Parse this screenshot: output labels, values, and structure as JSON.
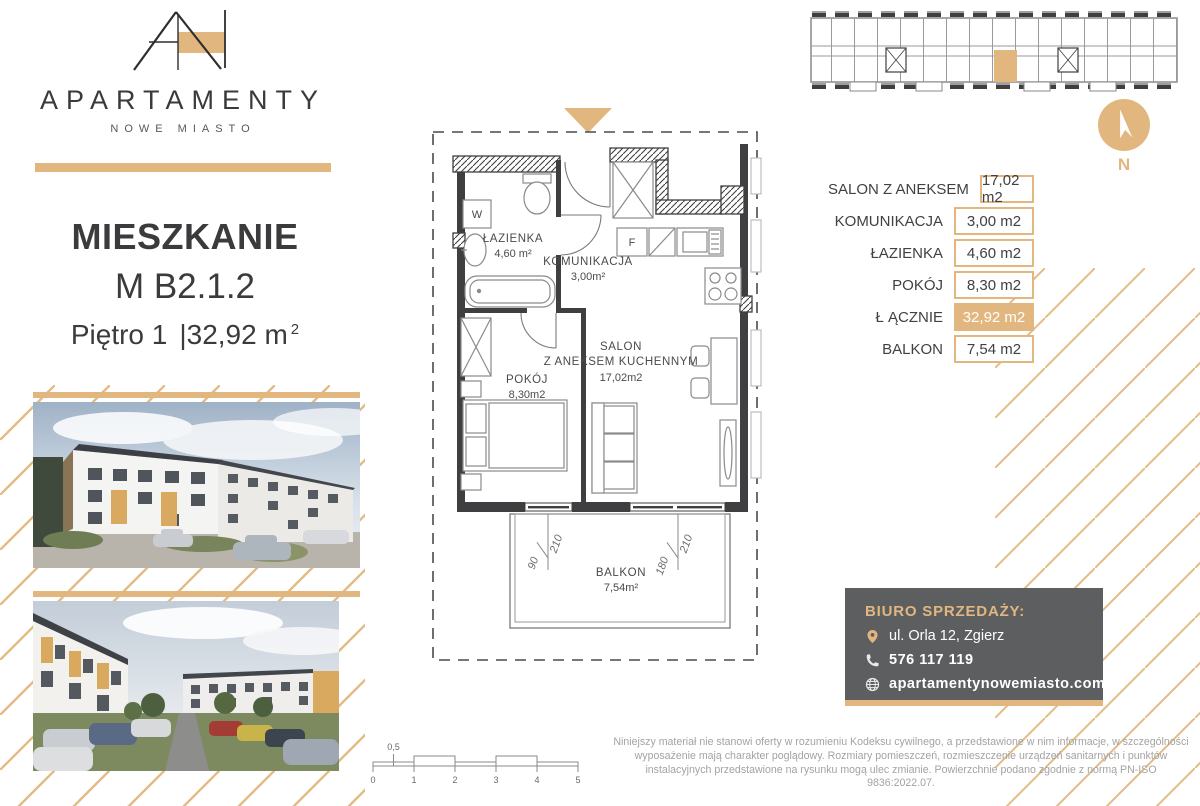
{
  "colors": {
    "gold": "#e2b77f",
    "dark_box": "#5d5e60",
    "line_dark": "#3f3f41",
    "text_gray": "#a3a3a3"
  },
  "brand": {
    "monogram": "AN",
    "name": "APARTAMENTY",
    "subtitle": "NOWE MIASTO"
  },
  "listing": {
    "title": "MIESZKANIE",
    "unit": "M B2.1.2",
    "floor": "Piętro 1",
    "area": "|32,92 m",
    "area_sup": "2"
  },
  "plan": {
    "rooms": {
      "lazienka": {
        "name": "ŁAZIENKA",
        "area": "4,60 m²"
      },
      "komunikacja": {
        "name": "KOMUNIKACJA",
        "area": "3,00m²"
      },
      "salon": {
        "name1": "SALON",
        "name2": "Z ANEKSEM KUCHENNYM",
        "area": "17,02m2"
      },
      "pokoj": {
        "name": "POKÓJ",
        "area": "8,30m2"
      },
      "balkon": {
        "name": "BALKON",
        "area": "7,54m²"
      }
    },
    "letters": {
      "washer": "W",
      "fridge": "F"
    },
    "dims": {
      "w1a": "90",
      "w1b": "210",
      "w2a": "180",
      "w2b": "210"
    }
  },
  "areas_table": {
    "rows": [
      {
        "label": "SALON Z ANEKSEM",
        "value": "17,02 m2"
      },
      {
        "label": "KOMUNIKACJA",
        "value": "3,00 m2"
      },
      {
        "label": "ŁAZIENKA",
        "value": "4,60 m2"
      },
      {
        "label": "POKÓJ",
        "value": "8,30 m2"
      },
      {
        "label": "Ł ĄCZNIE",
        "value": "32,92 m2"
      },
      {
        "label": "BALKON",
        "value": "7,54 m2"
      }
    ]
  },
  "compass": {
    "label": "N"
  },
  "sales_office": {
    "title": "BIURO SPRZEDAŻY:",
    "address": "ul. Orla 12, Zgierz",
    "phone": "576 117 119",
    "website": "apartamentynowemiasto.com"
  },
  "scale_bar": {
    "ticks": [
      "0",
      "1",
      "2",
      "3",
      "4",
      "5"
    ],
    "half": "0,5"
  },
  "disclaimer": "Niniejszy materiał nie stanowi oferty w rozumieniu Kodeksu cywilnego, a przedstawione w nim informacje, w szczególności wyposażenie mają charakter poglądowy. Rozmiary pomieszczeń, rozmieszczenie urządzeń sanitarnych i punktów instalacyjnych przedstawione na rysunku mogą ulec zmianie. Powierzchnie podano zgodnie z normą PN-ISO 9836:2022.07."
}
